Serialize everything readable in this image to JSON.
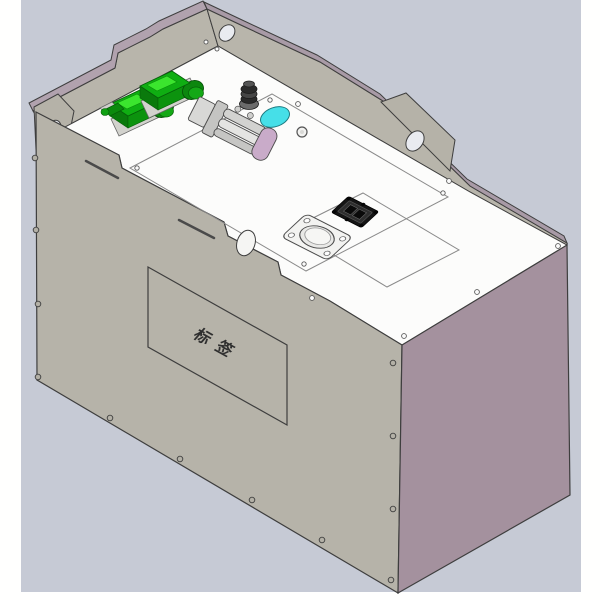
{
  "scene": {
    "view": "isometric-cad-render",
    "object": "sheet-metal-battery-enclosure",
    "label_text": "标签"
  },
  "colors": {
    "background": "#c6cad5",
    "margin_white": "#ffffff",
    "top_face": "#fcfcfb",
    "front_face": "#b6b3a9",
    "side_face": "#a4919e",
    "flange_band_mauve": "#b1a2ae",
    "outline": "#3e3e3e",
    "connector_green": "#0fae12",
    "connector_green_bright": "#3be52e",
    "port_cap_cyan": "#46dfe8",
    "end_cap_mauve": "#c9abc9",
    "cable_gland_black": "#2e2e2e",
    "square_connector_black": "#151515",
    "round_connector_gray": "#f3f3f1"
  },
  "components": [
    "back-flange-wall",
    "mounting-bracket-left",
    "mounting-bracket-peak",
    "mounting-bracket-right",
    "top-access-plate",
    "sub-panel-connectors",
    "sub-panel-interface",
    "green-industrial-connector-1",
    "green-industrial-connector-2",
    "cable-gland",
    "cyan-port-cap",
    "hv-connector-assembly",
    "mauve-end-cap",
    "square-interface-connector",
    "round-flange-connector",
    "label-plate",
    "vent-slots",
    "rivets"
  ]
}
